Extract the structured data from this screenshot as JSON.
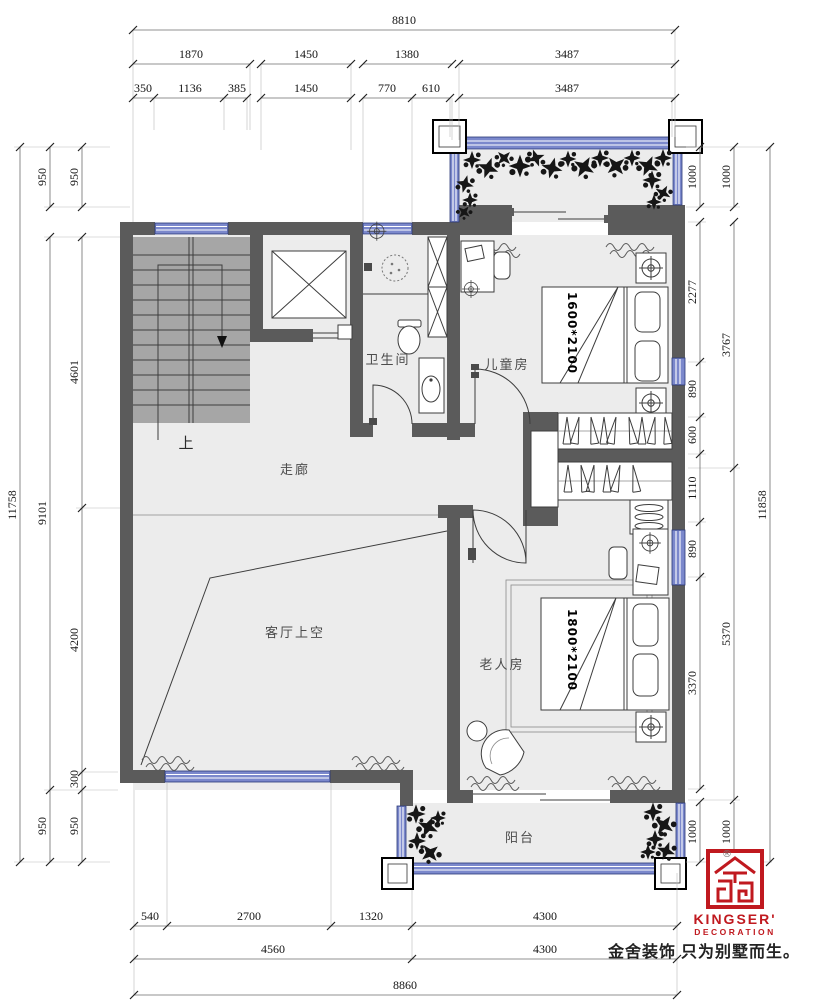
{
  "dims": {
    "top": {
      "row1": [
        "8810"
      ],
      "row2": [
        "1870",
        "1450",
        "1380",
        "3487"
      ],
      "row3": [
        "350",
        "1136",
        "385",
        "1450",
        "770",
        "610",
        "3487"
      ]
    },
    "bottom": {
      "row1": [
        "540",
        "2700",
        "1320",
        "4300"
      ],
      "row2": [
        "4560",
        "4300"
      ],
      "row3": [
        "8860"
      ]
    },
    "left": {
      "col1": [
        "11758"
      ],
      "col2": [
        "950",
        "9101",
        "950"
      ],
      "col3": [
        "950",
        "4601",
        "4200",
        "300",
        "950"
      ]
    },
    "right": {
      "colA": [
        "1000",
        "2277",
        "890",
        "600",
        "1110",
        "890",
        "3370",
        "1000"
      ],
      "colB": [
        "1000",
        "3767",
        "5370",
        "1000"
      ],
      "colC": [
        "11858"
      ]
    }
  },
  "rooms": {
    "bathroom": "卫生间",
    "children": "儿童房",
    "corridor": "走廊",
    "up": "上",
    "void": "客厅上空",
    "elder": "老人房",
    "balcony": "阳台"
  },
  "furniture": {
    "children_bed": "1600*2100",
    "elder_bed": "1800*2100"
  },
  "logo": {
    "brand": "KINGSER'",
    "division": "DECORATION",
    "tagline": "金舍装饰 只为别墅而生。",
    "registered": "®"
  },
  "colors": {
    "wall": "#5b5b5b",
    "window_blue": "#7b88cc",
    "window_border": "#2a3878",
    "stair_fill": "#a6a6a6",
    "floor": "#ececec",
    "logo_red": "#c0191f"
  }
}
